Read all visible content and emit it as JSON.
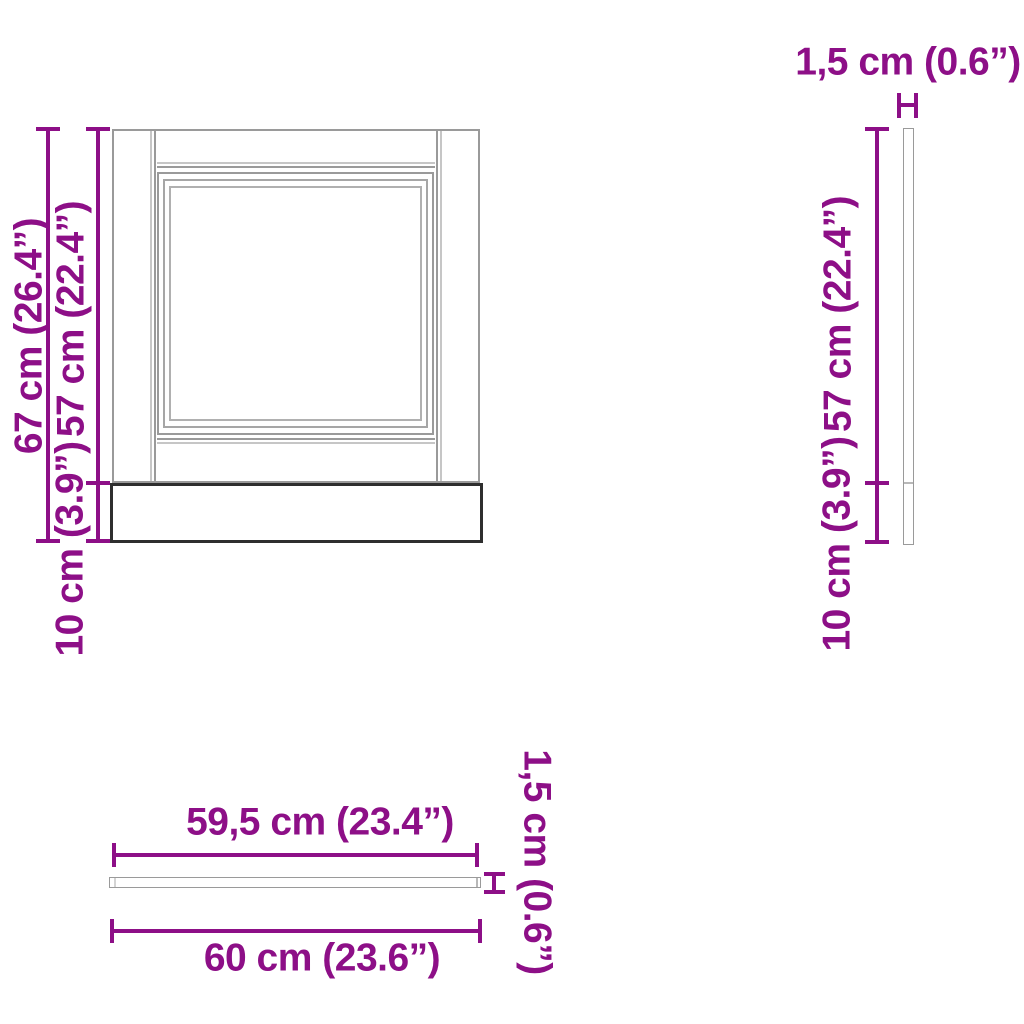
{
  "diagram": {
    "colors": {
      "dimension": "#8d0f87",
      "panel_outline": "#9a9a9a",
      "panel_outline_2": "#a6a6a6",
      "panel_outline_3": "#b0b0b0",
      "panel_outline_light": "#c6c6c6",
      "panel_outline_dark": "#2e2e2e",
      "panel_seam": "#b8b8b8",
      "background": "#ffffff"
    },
    "front": {
      "height_total_label": "67 cm (26.4”)",
      "door_height_label": "57 cm (22.4”)",
      "plinth_height_label": "10 cm (3.9”)"
    },
    "side": {
      "thickness_label": "1,5 cm (0.6”)",
      "door_height_label": "57 cm (22.4”)",
      "plinth_height_label": "10 cm (3.9”)"
    },
    "top": {
      "length_inner_label": "59,5 cm (23.4”)",
      "length_total_label": "60 cm (23.6”)",
      "thickness_label": "1,5 cm (0.6”)"
    }
  }
}
